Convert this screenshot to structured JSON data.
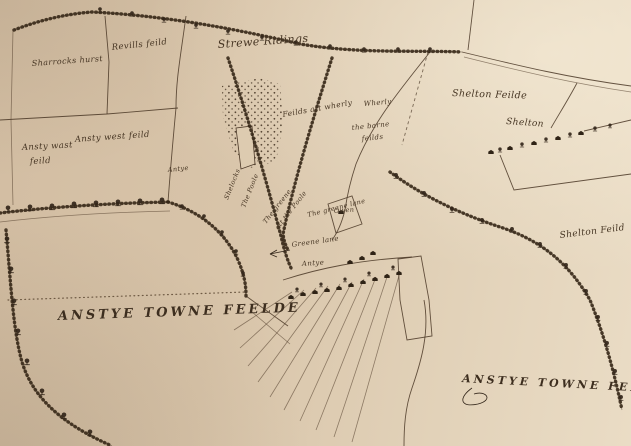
{
  "colors": {
    "paper": "#d8c4a9",
    "paper_light": "#eadcc5",
    "ink": "#352717",
    "label_ink": "#463523"
  },
  "region_labels": {
    "sharterks_hurst": "Sharrocks hurst",
    "revills_feild": "Revills feild",
    "strewe_ridings": "Strewe Ridings",
    "ansty_west_feild": "Ansty west feild",
    "ansty_wast_feild_line1": "Ansty wast",
    "ansty_wast_feild_line2": "feild",
    "feilds_att_wherly": "Feilds att wherly",
    "wherly": "Wherly",
    "barne_feilds_line1": "the barne",
    "barne_feilds_line2": "feilds",
    "shelton_feilde": "Shelton Feilde",
    "shelton": "Shelton",
    "shelton_feild_edge": "Shelton Feild",
    "anstye_towne_feelde_sw": "ANSTYE TOWNE FEELDE",
    "anstye_towne_feeld_se": "ANSTYE TOWNE FEELD"
  },
  "place_labels": {
    "greene_lane": "Greene lane",
    "antye_village": "Antye",
    "antye_road": "Antye",
    "owen": "Owen",
    "shelocks": "Shelocks",
    "the_poole": "The Poole",
    "greene_att_poole_line1": "The greene",
    "greene_att_poole_line2": "att the Poole",
    "greene_lane_diag": "The greene lane"
  }
}
